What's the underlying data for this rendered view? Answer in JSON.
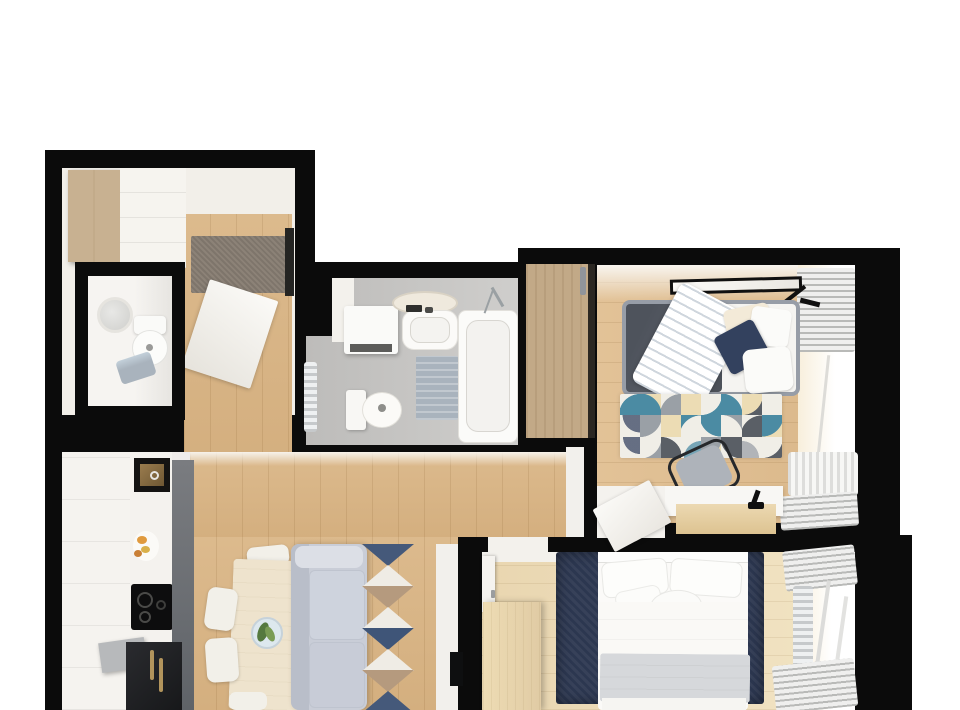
{
  "title": "Two-bedroom apartment 3D floor plan (top-down render)",
  "visible_text": [],
  "palette": {
    "wall": "#0b0b0b",
    "bg": "#ffffff",
    "hallFloor": "#f2efe9",
    "wood": "#dcba8d",
    "woodLight": "#e9d6b0",
    "white": "#f7f5f1",
    "woodCab": "#c8b191",
    "rugGray": "#8c8277",
    "bathFloor": "#bdbcba",
    "matBlue": "#a9b3bd",
    "chrome": "#c3c6c9",
    "closetWood": "#c2a987",
    "bedDark": "#565b64",
    "bedFrame": "#979da7",
    "pillowNavy": "#33415e",
    "glow": "#f8efdc",
    "sofa": "#c9cdd7",
    "rugNavy": "#2c3750",
    "table": "#eee3cd",
    "chair": "#f2f0e9",
    "counterDark": "#5f6368",
    "black": "#17181a",
    "gold": "#b2945c",
    "dresser": "#e0cba4",
    "blanket": "#d6d8db",
    "teal": "#4b8ba3",
    "beige": "#ecdcb4",
    "gray2": "#9aa0a6",
    "dark2": "#5a5f66",
    "cream": "#f0eee7"
  },
  "rooms": [
    {
      "id": "entry-hall",
      "label": "Entry hall",
      "furniture": [
        "wood wardrobe",
        "white closet",
        "gray doormat",
        "open entry door"
      ]
    },
    {
      "id": "wc",
      "label": "WC",
      "furniture": [
        "round mirror",
        "toilet",
        "blue towel"
      ]
    },
    {
      "id": "bathroom",
      "label": "Bathroom",
      "furniture": [
        "washer cabinet",
        "round mirror",
        "sink",
        "bathtub",
        "toilet",
        "bath mat",
        "towel radiator"
      ]
    },
    {
      "id": "bedroom-1",
      "label": "Bedroom 1",
      "furniture": [
        "sliding wardrobe",
        "double bed",
        "geometric rug",
        "desk",
        "office chair",
        "desk lamp",
        "ceiling light",
        "window with curtains",
        "radiator",
        "open door"
      ]
    },
    {
      "id": "living-kitchen",
      "label": "Living room / kitchen",
      "furniture": [
        "kitchen cabinets",
        "built-in sink unit",
        "cooktop",
        "fridge",
        "dining table",
        "four chairs",
        "decor plate",
        "sofa",
        "triangle rug",
        "tv unit",
        "tv"
      ]
    },
    {
      "id": "bedroom-2",
      "label": "Bedroom 2",
      "furniture": [
        "double bed",
        "navy rug",
        "dresser",
        "door",
        "window with curtains",
        "radiator"
      ]
    }
  ],
  "rug_bedroom1": {
    "cols": 8,
    "rows": 3,
    "cells": [
      {
        "b": "#f0eee7",
        "f": "#4b8ba3",
        "p": "br"
      },
      {
        "b": "#ecdcb4",
        "f": "#4b8ba3",
        "p": "bl"
      },
      {
        "b": "#f0eee7",
        "f": "#9aa0a6",
        "p": "br"
      },
      {
        "b": "#ecdcb4",
        "f": "#f0eee7",
        "p": "none"
      },
      {
        "b": "#4b8ba3",
        "f": "#f0eee7",
        "p": "tl"
      },
      {
        "b": "#f0eee7",
        "f": "#4b8ba3",
        "p": "bl"
      },
      {
        "b": "#5a5f66",
        "f": "#ecdcb4",
        "p": "tl"
      },
      {
        "b": "#f0eee7",
        "f": "#9aa0a6",
        "p": "none"
      },
      {
        "b": "#f0eee7",
        "f": "#33415e",
        "p": "tr",
        "dot": 1
      },
      {
        "b": "#f0eee7",
        "f": "#9aa0a6",
        "p": "tl"
      },
      {
        "b": "#ecdcb4",
        "f": "#f0eee7",
        "p": "none"
      },
      {
        "b": "#4b8ba3",
        "f": "#f0eee7",
        "p": "br"
      },
      {
        "b": "#f0eee7",
        "f": "#4b8ba3",
        "p": "tr"
      },
      {
        "b": "#9aa0a6",
        "f": "#f0eee7",
        "p": "bl"
      },
      {
        "b": "#f0eee7",
        "f": "#5a5f66",
        "p": "br"
      },
      {
        "b": "#ecdcb4",
        "f": "#4b8ba3",
        "p": "tl"
      },
      {
        "b": "#f0eee7",
        "f": "#33415e",
        "p": "tr",
        "dot": 1
      },
      {
        "b": "#9aa0a6",
        "f": "#f0eee7",
        "p": "tl"
      },
      {
        "b": "#f0eee7",
        "f": "#5a5f66",
        "p": "bl"
      },
      {
        "b": "#f0eee7",
        "f": "#4b8ba3",
        "p": "br",
        "dot": 1
      },
      {
        "b": "#ecdcb4",
        "f": "#9aa0a6",
        "p": "tl"
      },
      {
        "b": "#f0eee7",
        "f": "#5a5f66",
        "p": "tr"
      },
      {
        "b": "#f0eee7",
        "f": "#9aa0a6",
        "p": "bl",
        "dot": 1
      },
      {
        "b": "#5a5f66",
        "f": "#f0eee7",
        "p": "tl"
      }
    ]
  },
  "rug_living": {
    "triangle_colors": [
      "#45597a",
      "#efece5",
      "#b59a7e",
      "#efece5",
      "#3f5578",
      "#efece5",
      "#b59a7e",
      "#45597a"
    ]
  }
}
